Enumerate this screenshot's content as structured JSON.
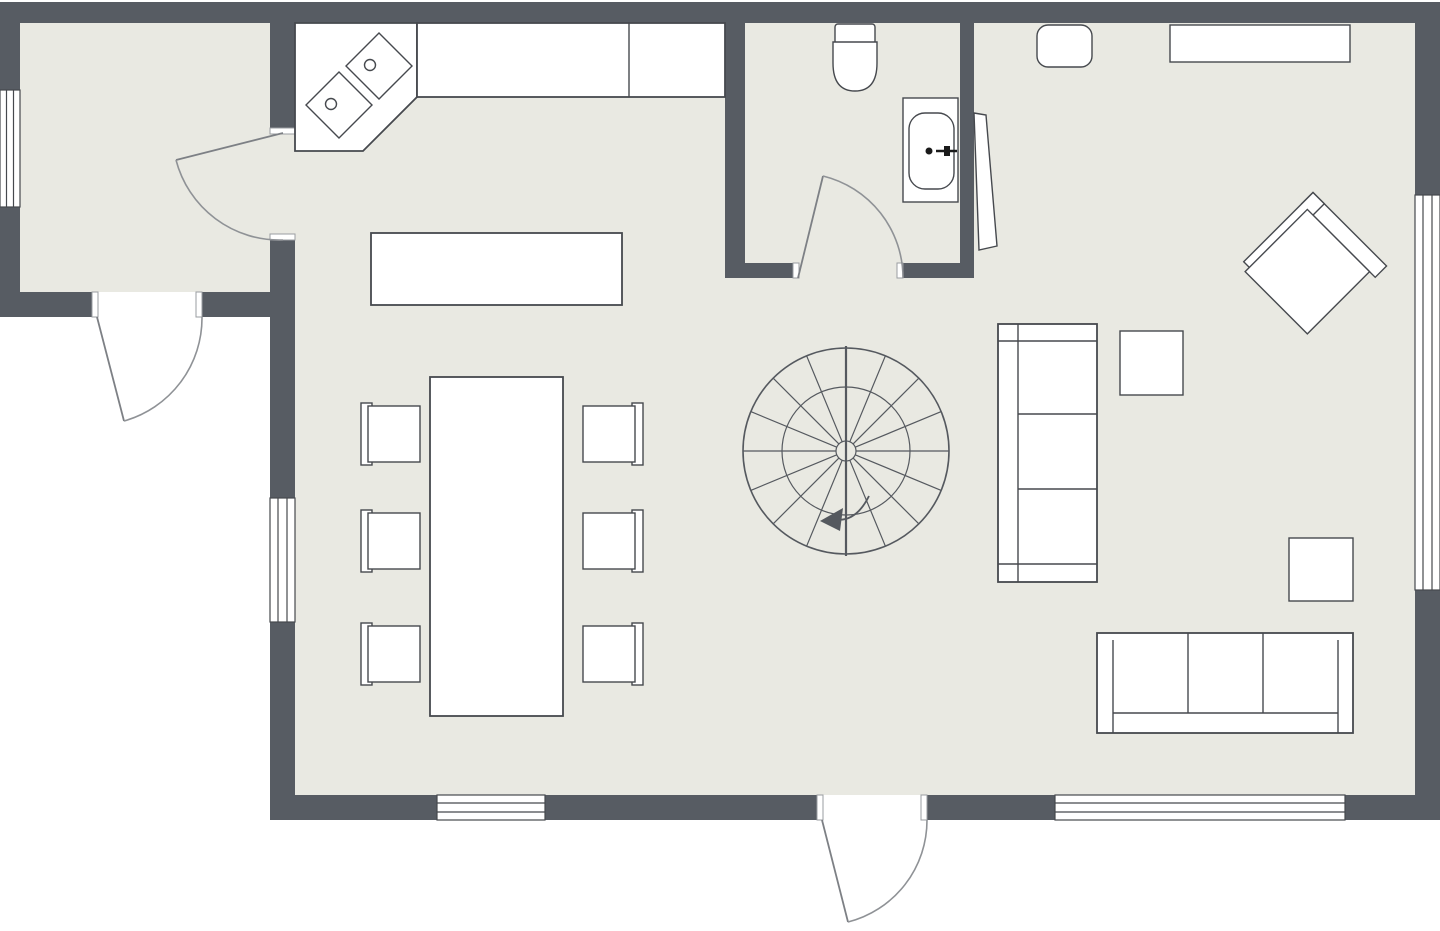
{
  "app": {
    "title": "2D floor plan",
    "view": "top-down"
  },
  "palette": {
    "wall": "#575c63",
    "floor": "#e9e9e2",
    "outside": "#ffffff",
    "fixture_fill": "#ffffff",
    "fixture_outline": "#46494e",
    "door_swing": "#8f9296",
    "stair_line": "#55595f"
  },
  "labels": {
    "plan": "First floor plan",
    "entry_room": "Entry room",
    "main_room": "Open kitchen, dining and living area",
    "bathroom": "Bathroom",
    "corner_counter": "Kitchen corner counter with cooktop",
    "burner": "Cooktop burner",
    "counter": "Kitchen counter",
    "island": "Kitchen island",
    "dining_table": "Dining table",
    "dining_chair": "Dining chair",
    "toilet": "Toilet",
    "bathtub": "Bathtub",
    "spiral_staircase": "Spiral staircase",
    "pouf": "Pouf",
    "sideboard": "Sideboard",
    "armchair": "Armchair",
    "side_table": "Side table",
    "sofa_left": "Three-seat sofa",
    "sofa_bottom": "Three-seat sofa",
    "window": "Window",
    "side_door": "Entry room exterior door",
    "interior_door": "Door between entry room and kitchen",
    "bathroom_door": "Bathroom door",
    "main_door": "Main entrance door",
    "open_door": "Open door leaf"
  }
}
